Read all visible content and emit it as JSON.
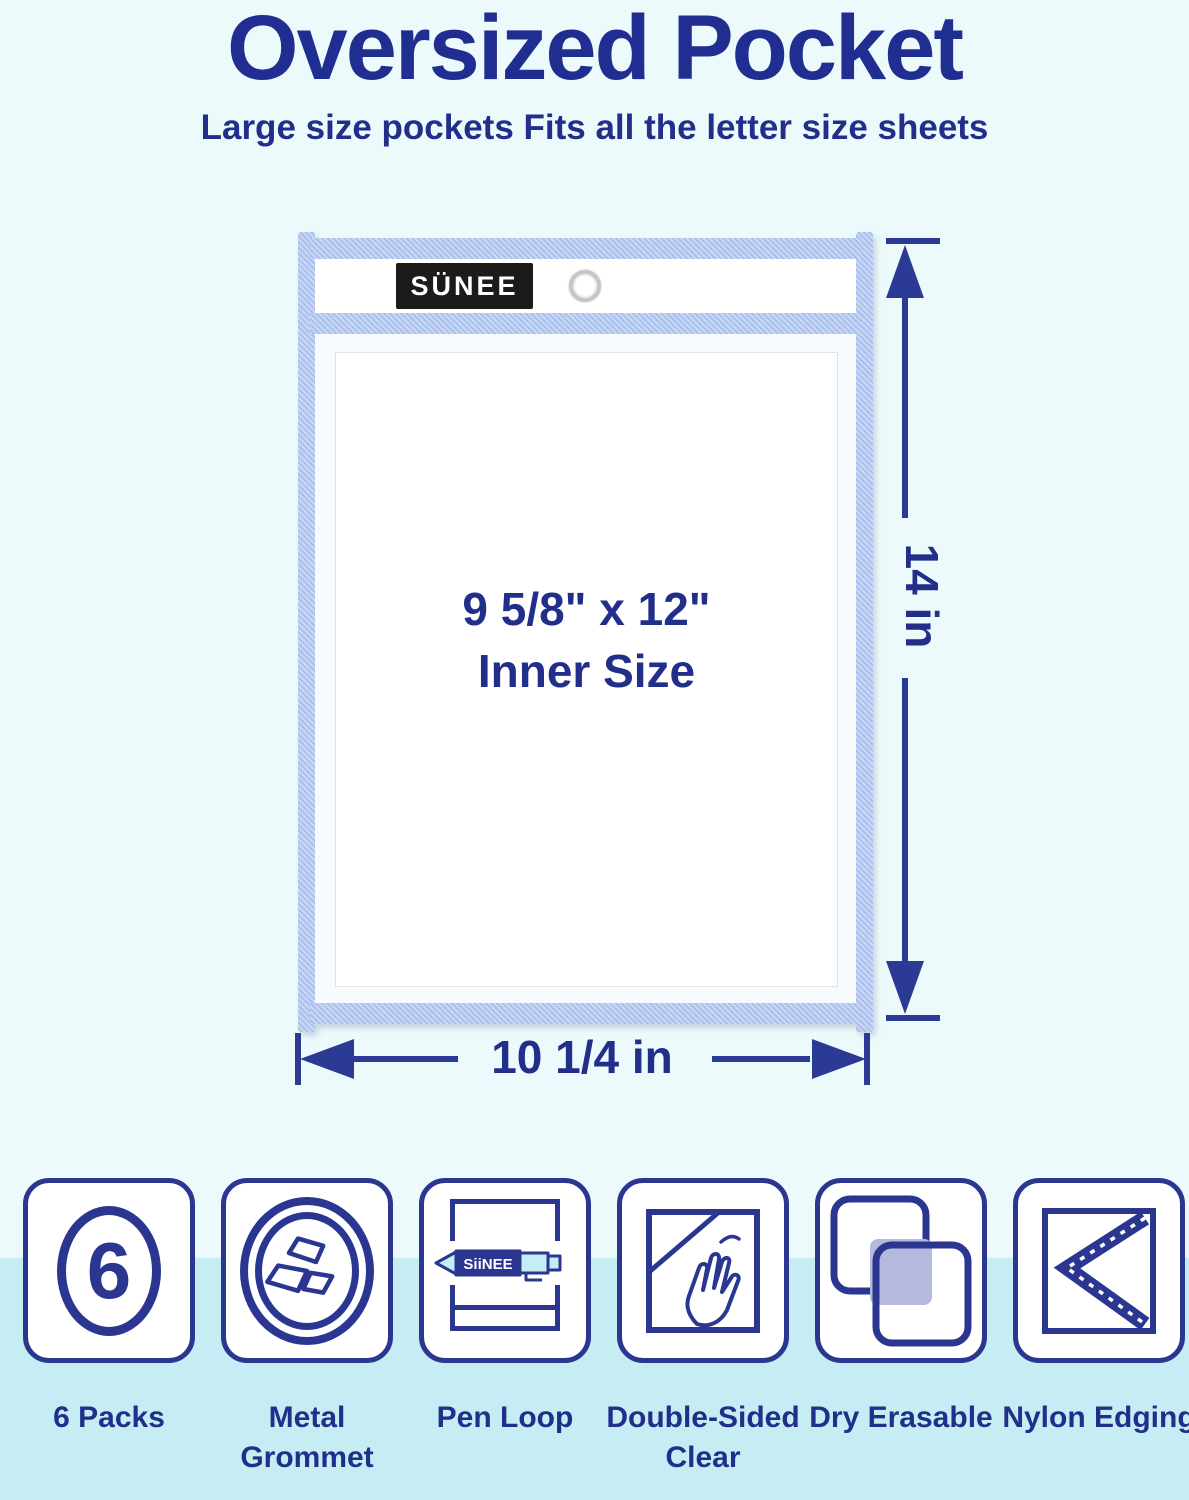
{
  "header": {
    "title": "Oversized Pocket",
    "subtitle": "Large size pockets Fits all the letter size sheets"
  },
  "pocket": {
    "brand_label": "SÜNEE",
    "inner_size": {
      "line1": "9 5/8\" x 12\"",
      "line2": "Inner Size"
    }
  },
  "dimensions": {
    "height": "14 in",
    "width": "10 1/4 in"
  },
  "features": [
    {
      "label": "6 Packs",
      "icon": "six-count-icon",
      "count": "6"
    },
    {
      "label": "Metal Grommet",
      "icon": "metal-grommet-icon"
    },
    {
      "label": "Pen Loop",
      "icon": "pen-loop-icon",
      "pen_brand": "SiiNEE"
    },
    {
      "label": "Double-Sided Clear",
      "icon": "double-sided-clear-icon"
    },
    {
      "label": "Dry Erasable",
      "icon": "dry-erasable-icon"
    },
    {
      "label": "Nylon Edging",
      "icon": "nylon-edging-icon"
    }
  ],
  "colors": {
    "navy_text": "#212e8a",
    "navy_line": "#2b3a94",
    "icon_navy": "#2b3691",
    "edging_blue": "#a9c0ee",
    "background_top": "#ecfafb",
    "background_band": "#c6edf3",
    "lavender_fill": "#b5b9dd",
    "pen_cyan": "#c3eef3",
    "brand_black": "#1b1b1b"
  }
}
